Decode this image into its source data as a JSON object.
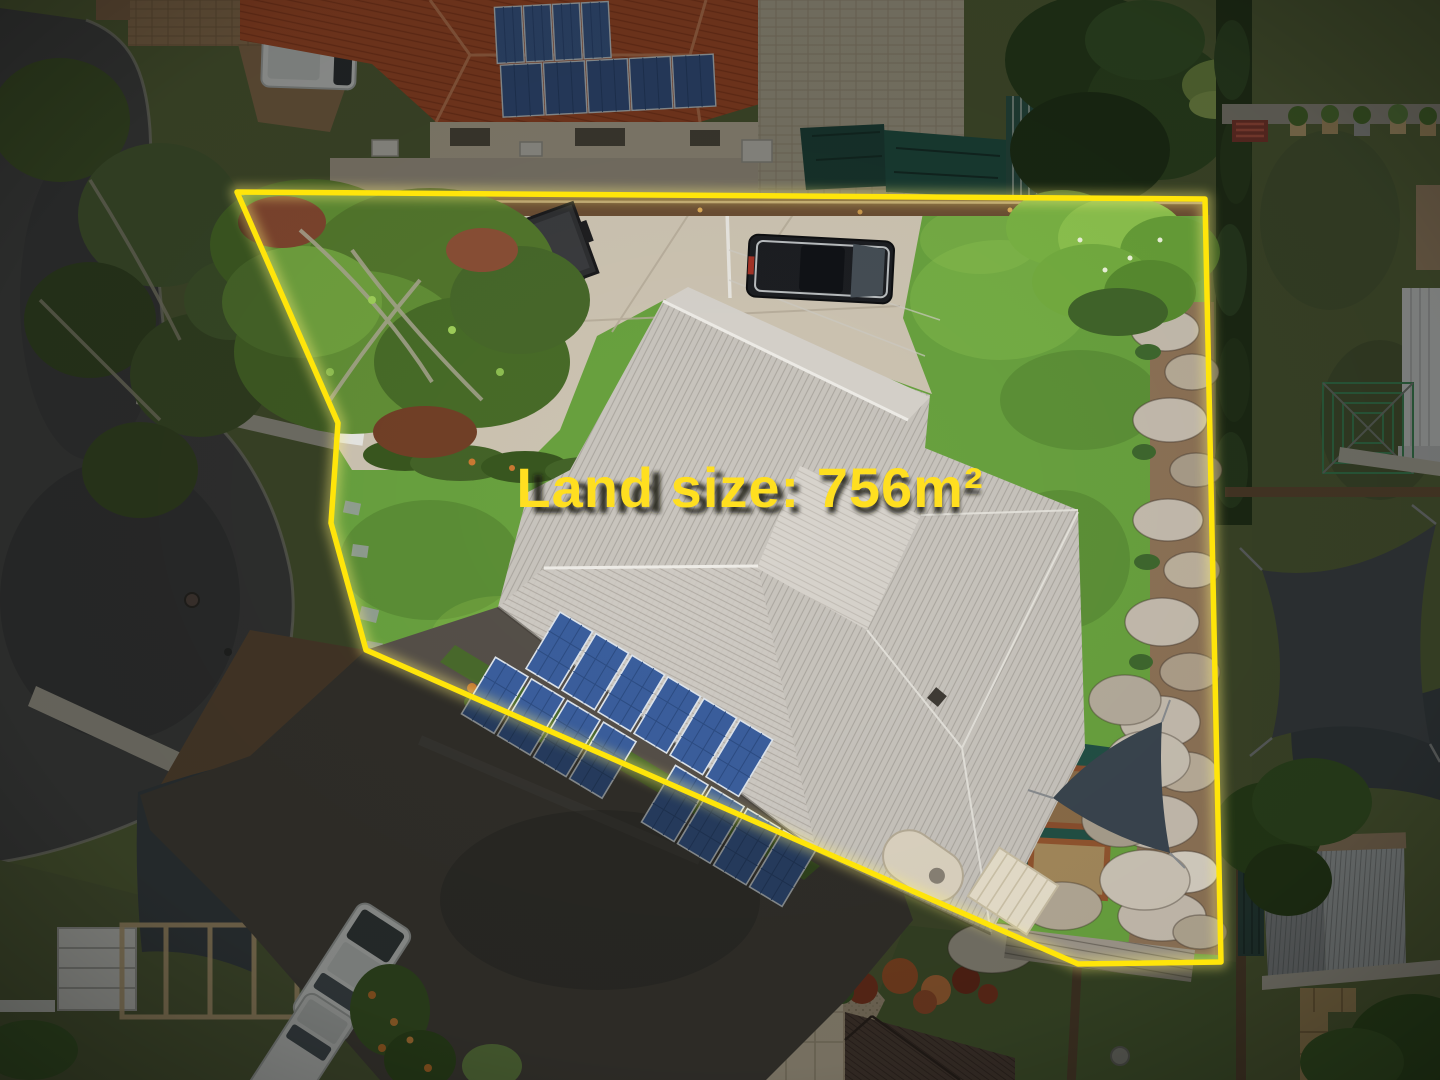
{
  "meta": {
    "type": "aerial-property-photo",
    "description": "Top-down drone photograph of a suburban property outlined with a yellow boundary line and a land size caption"
  },
  "overlay": {
    "label": "Land size: 756m²",
    "land_size_value": "756",
    "land_size_unit": "m²",
    "text_color": "#ffdf20",
    "text_shadow_color": "rgba(25,24,18,0.85)",
    "boundary_color": "#ffe50a",
    "boundary_glow_color": "#fff27a"
  },
  "scene": {
    "features": [
      "cul-de-sac road",
      "street trees",
      "neighbour house with terracotta roof and solar panels",
      "subject house with white metal roof and solar array",
      "concrete driveway with box trailer and black 4WD",
      "front lawn",
      "back lawn",
      "rock retaining wall",
      "shade sails",
      "water tank",
      "garden shed",
      "timber garden beds",
      "neighbour driveway with two white vehicles",
      "backyard clothesline",
      "metal shed",
      "hedges and tropical garden"
    ],
    "palette": {
      "road": "#474749",
      "lawn_inside": "#69a23f",
      "lawn_outside": "#5a683c",
      "concrete": "#cdc4b2",
      "asphalt_driveway": "#4a4641",
      "house_roof": "#c9c5be",
      "terracotta_roof": "#b8522c",
      "solar_panel": "#3b5f9e",
      "rock_wall": "#c5bcae",
      "shade_sail": "#454b52",
      "dim_outside": "rgba(10,12,8,0.42)"
    }
  }
}
